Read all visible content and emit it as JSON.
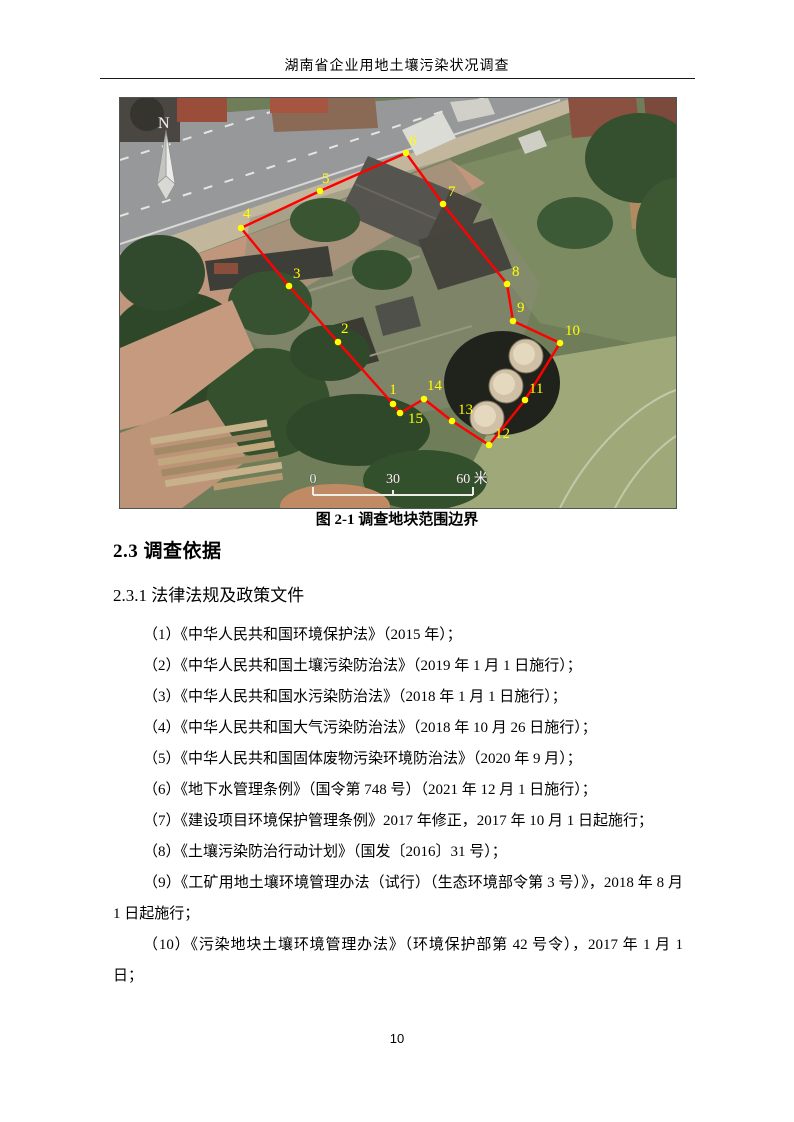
{
  "header": {
    "title": "湖南省企业用地土壤污染状况调查"
  },
  "figure": {
    "caption": "图  2-1 调查地块范围边界",
    "north_label": "N",
    "scale_bar": {
      "labels": [
        "0",
        "30",
        "60 米"
      ]
    },
    "boundary_color": "#ff0000",
    "marker_color": "#ffff00",
    "points": [
      {
        "id": "1",
        "x": 273,
        "y": 306,
        "lx": 0,
        "ly": -10,
        "anchor": "middle"
      },
      {
        "id": "2",
        "x": 218,
        "y": 244,
        "lx": 3,
        "ly": -9
      },
      {
        "id": "3",
        "x": 169,
        "y": 188,
        "lx": 4,
        "ly": -8
      },
      {
        "id": "4",
        "x": 121,
        "y": 130,
        "lx": 2,
        "ly": -10
      },
      {
        "id": "5",
        "x": 200,
        "y": 93,
        "lx": 2,
        "ly": -8
      },
      {
        "id": "6",
        "x": 286,
        "y": 55,
        "lx": 3,
        "ly": -8
      },
      {
        "id": "7",
        "x": 323,
        "y": 106,
        "lx": 5,
        "ly": -8
      },
      {
        "id": "8",
        "x": 387,
        "y": 186,
        "lx": 5,
        "ly": -8
      },
      {
        "id": "9",
        "x": 393,
        "y": 223,
        "lx": 4,
        "ly": -9
      },
      {
        "id": "10",
        "x": 440,
        "y": 245,
        "lx": 5,
        "ly": -8
      },
      {
        "id": "11",
        "x": 405,
        "y": 302,
        "lx": 4,
        "ly": -7
      },
      {
        "id": "12",
        "x": 369,
        "y": 347,
        "lx": 6,
        "ly": -7
      },
      {
        "id": "13",
        "x": 332,
        "y": 323,
        "lx": 6,
        "ly": -7
      },
      {
        "id": "14",
        "x": 304,
        "y": 301,
        "lx": 3,
        "ly": -9
      },
      {
        "id": "15",
        "x": 280,
        "y": 315,
        "lx": 8,
        "ly": 10
      }
    ]
  },
  "sections": {
    "h1": "2.3  调查依据",
    "h2": "2.3.1  法律法规及政策文件"
  },
  "list_items": [
    "（1）《中华人民共和国环境保护法》（2015 年）；",
    "（2）《中华人民共和国土壤污染防治法》（2019 年 1 月 1 日施行）；",
    "（3）《中华人民共和国水污染防治法》（2018 年 1 月 1 日施行）；",
    "（4）《中华人民共和国大气污染防治法》（2018 年 10 月 26 日施行）；",
    "（5）《中华人民共和国固体废物污染环境防治法》（2020 年 9 月）；",
    "（6）《地下水管理条例》（国令第 748 号）（2021 年 12 月 1 日施行）；",
    "（7）《建设项目环境保护管理条例》2017 年修正，2017 年 10 月 1 日起施行；",
    "（8）《土壤污染防治行动计划》（国发〔2016〕31 号）；",
    "（9）《工矿用地土壤环境管理办法（试行）（生态环境部令第 3 号）》，2018 年 8 月 1 日起施行；",
    "（10）《污染地块土壤环境管理办法》（环境保护部第 42 号令），2017 年 1 月 1 日；"
  ],
  "footer": {
    "page_number": "10"
  }
}
